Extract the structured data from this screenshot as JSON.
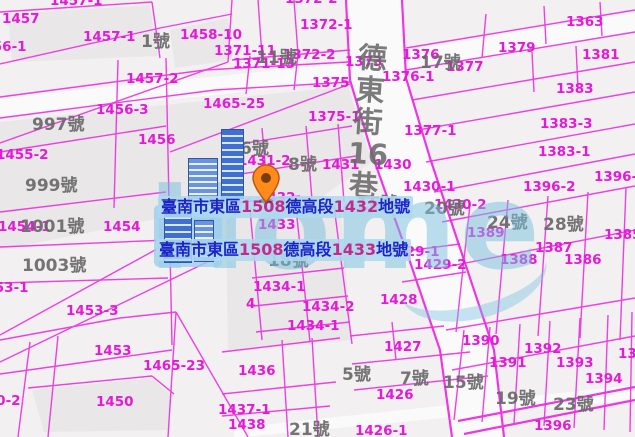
{
  "map": {
    "watermark_text": "Home",
    "street_chars": [
      "德",
      "東",
      "街",
      "16",
      "巷"
    ],
    "selected_parcels": [
      {
        "p0": "臺南市東區",
        "p1": "1508",
        "p2": "德高段",
        "p3": "1432",
        "p4": "地號"
      },
      {
        "p0": "臺南市東區",
        "p1": "1508",
        "p2": "德高段",
        "p3": "1433",
        "p4": "地號"
      }
    ],
    "colors": {
      "parcel_line": "#ee2ce2",
      "parcel_label": "#e51ad8",
      "house_number": "#6a6a6a",
      "label_text_zh": "#1c24c8",
      "label_text_num": "#c32a8c",
      "label_background": "#add8ee",
      "pin": "#ff8c1a",
      "building": "#3f6fd0",
      "watermark": "#78c0dd"
    },
    "parcel_labels": [
      {
        "text": "1457-1",
        "x": 50,
        "y": -6
      },
      {
        "text": "1457",
        "x": 2,
        "y": 12
      },
      {
        "text": "1456-1",
        "x": -26,
        "y": 40
      },
      {
        "text": "1457-1",
        "x": 83,
        "y": 30
      },
      {
        "text": "1458-10",
        "x": 180,
        "y": 28
      },
      {
        "text": "1457-2",
        "x": 126,
        "y": 72
      },
      {
        "text": "1372-2",
        "x": 285,
        "y": -8
      },
      {
        "text": "1372-1",
        "x": 300,
        "y": 18
      },
      {
        "text": "1371-11",
        "x": 214,
        "y": 44
      },
      {
        "text": "1372-2",
        "x": 283,
        "y": 48
      },
      {
        "text": "1371-13",
        "x": 233,
        "y": 57
      },
      {
        "text": "1373",
        "x": 345,
        "y": 55
      },
      {
        "text": "1375",
        "x": 312,
        "y": 76
      },
      {
        "text": "1376",
        "x": 402,
        "y": 48
      },
      {
        "text": "1376-1",
        "x": 382,
        "y": 70
      },
      {
        "text": "1377",
        "x": 446,
        "y": 60
      },
      {
        "text": "1379",
        "x": 498,
        "y": 41
      },
      {
        "text": "1363",
        "x": 566,
        "y": 15
      },
      {
        "text": "1381",
        "x": 582,
        "y": 48
      },
      {
        "text": "1383",
        "x": 556,
        "y": 82
      },
      {
        "text": "1375-1",
        "x": 308,
        "y": 110
      },
      {
        "text": "1377-1",
        "x": 404,
        "y": 124
      },
      {
        "text": "1383-3",
        "x": 540,
        "y": 117
      },
      {
        "text": "1383-1",
        "x": 538,
        "y": 145
      },
      {
        "text": "1396-1",
        "x": 594,
        "y": 170
      },
      {
        "text": "1396-2",
        "x": 523,
        "y": 180
      },
      {
        "text": "1465-25",
        "x": 203,
        "y": 97
      },
      {
        "text": "1456-3",
        "x": 96,
        "y": 103
      },
      {
        "text": "1456",
        "x": 138,
        "y": 133
      },
      {
        "text": "1455-2",
        "x": -4,
        "y": 148
      },
      {
        "text": "1431-2",
        "x": 238,
        "y": 154
      },
      {
        "text": "1431",
        "x": 322,
        "y": 158
      },
      {
        "text": "1430",
        "x": 374,
        "y": 158
      },
      {
        "text": "1430-1",
        "x": 403,
        "y": 180
      },
      {
        "text": "1430-2",
        "x": 434,
        "y": 198
      },
      {
        "text": "1432",
        "x": 258,
        "y": 191
      },
      {
        "text": "1433",
        "x": 258,
        "y": 218
      },
      {
        "text": "1429-1",
        "x": 387,
        "y": 245
      },
      {
        "text": "1429-2",
        "x": 414,
        "y": 258
      },
      {
        "text": "1428",
        "x": 380,
        "y": 293
      },
      {
        "text": "1454-1",
        "x": -2,
        "y": 220
      },
      {
        "text": "1454",
        "x": 103,
        "y": 220
      },
      {
        "text": "1434-1",
        "x": 253,
        "y": 280
      },
      {
        "text": "1434-2",
        "x": 302,
        "y": 300
      },
      {
        "text": "1434-1",
        "x": 287,
        "y": 319
      },
      {
        "text": "4",
        "x": 246,
        "y": 297
      },
      {
        "text": "1453-1",
        "x": -24,
        "y": 281
      },
      {
        "text": "1453-3",
        "x": 66,
        "y": 304
      },
      {
        "text": "1453",
        "x": 94,
        "y": 344
      },
      {
        "text": "1465-23",
        "x": 143,
        "y": 359
      },
      {
        "text": "1450",
        "x": 96,
        "y": 395
      },
      {
        "text": "1450-2",
        "x": -32,
        "y": 394
      },
      {
        "text": "1437-1",
        "x": 218,
        "y": 403
      },
      {
        "text": "1438",
        "x": 228,
        "y": 418
      },
      {
        "text": "1436",
        "x": 238,
        "y": 364
      },
      {
        "text": "1427",
        "x": 384,
        "y": 340
      },
      {
        "text": "1426",
        "x": 376,
        "y": 388
      },
      {
        "text": "1426-1",
        "x": 355,
        "y": 424
      },
      {
        "text": "1390",
        "x": 462,
        "y": 334
      },
      {
        "text": "1392",
        "x": 524,
        "y": 342
      },
      {
        "text": "1391",
        "x": 489,
        "y": 356
      },
      {
        "text": "1393",
        "x": 556,
        "y": 356
      },
      {
        "text": "1394",
        "x": 585,
        "y": 372
      },
      {
        "text": "1395",
        "x": 618,
        "y": 347
      },
      {
        "text": "1385",
        "x": 604,
        "y": 228
      },
      {
        "text": "1389",
        "x": 467,
        "y": 226
      },
      {
        "text": "1387",
        "x": 535,
        "y": 241
      },
      {
        "text": "1388",
        "x": 500,
        "y": 253
      },
      {
        "text": "1386",
        "x": 564,
        "y": 253
      },
      {
        "text": "1396",
        "x": 534,
        "y": 419
      }
    ],
    "house_numbers": [
      {
        "text": "1號",
        "x": 141,
        "y": 33
      },
      {
        "text": "11號",
        "x": 256,
        "y": 49
      },
      {
        "text": "17號",
        "x": 420,
        "y": 54
      },
      {
        "text": "997號",
        "x": 32,
        "y": 116
      },
      {
        "text": "999號",
        "x": 25,
        "y": 177
      },
      {
        "text": "1001號",
        "x": 20,
        "y": 218
      },
      {
        "text": "1003號",
        "x": 22,
        "y": 257
      },
      {
        "text": "6號",
        "x": 240,
        "y": 140
      },
      {
        "text": "8號",
        "x": 288,
        "y": 156
      },
      {
        "text": "16號",
        "x": 357,
        "y": 195
      },
      {
        "text": "20號",
        "x": 424,
        "y": 200
      },
      {
        "text": "24號",
        "x": 487,
        "y": 214
      },
      {
        "text": "28號",
        "x": 543,
        "y": 216
      },
      {
        "text": "18號",
        "x": 268,
        "y": 252
      },
      {
        "text": "5號",
        "x": 342,
        "y": 366
      },
      {
        "text": "7號",
        "x": 400,
        "y": 370
      },
      {
        "text": "15號",
        "x": 443,
        "y": 374
      },
      {
        "text": "19號",
        "x": 495,
        "y": 390
      },
      {
        "text": "23號",
        "x": 553,
        "y": 396
      },
      {
        "text": "21號",
        "x": 289,
        "y": 421
      }
    ]
  }
}
